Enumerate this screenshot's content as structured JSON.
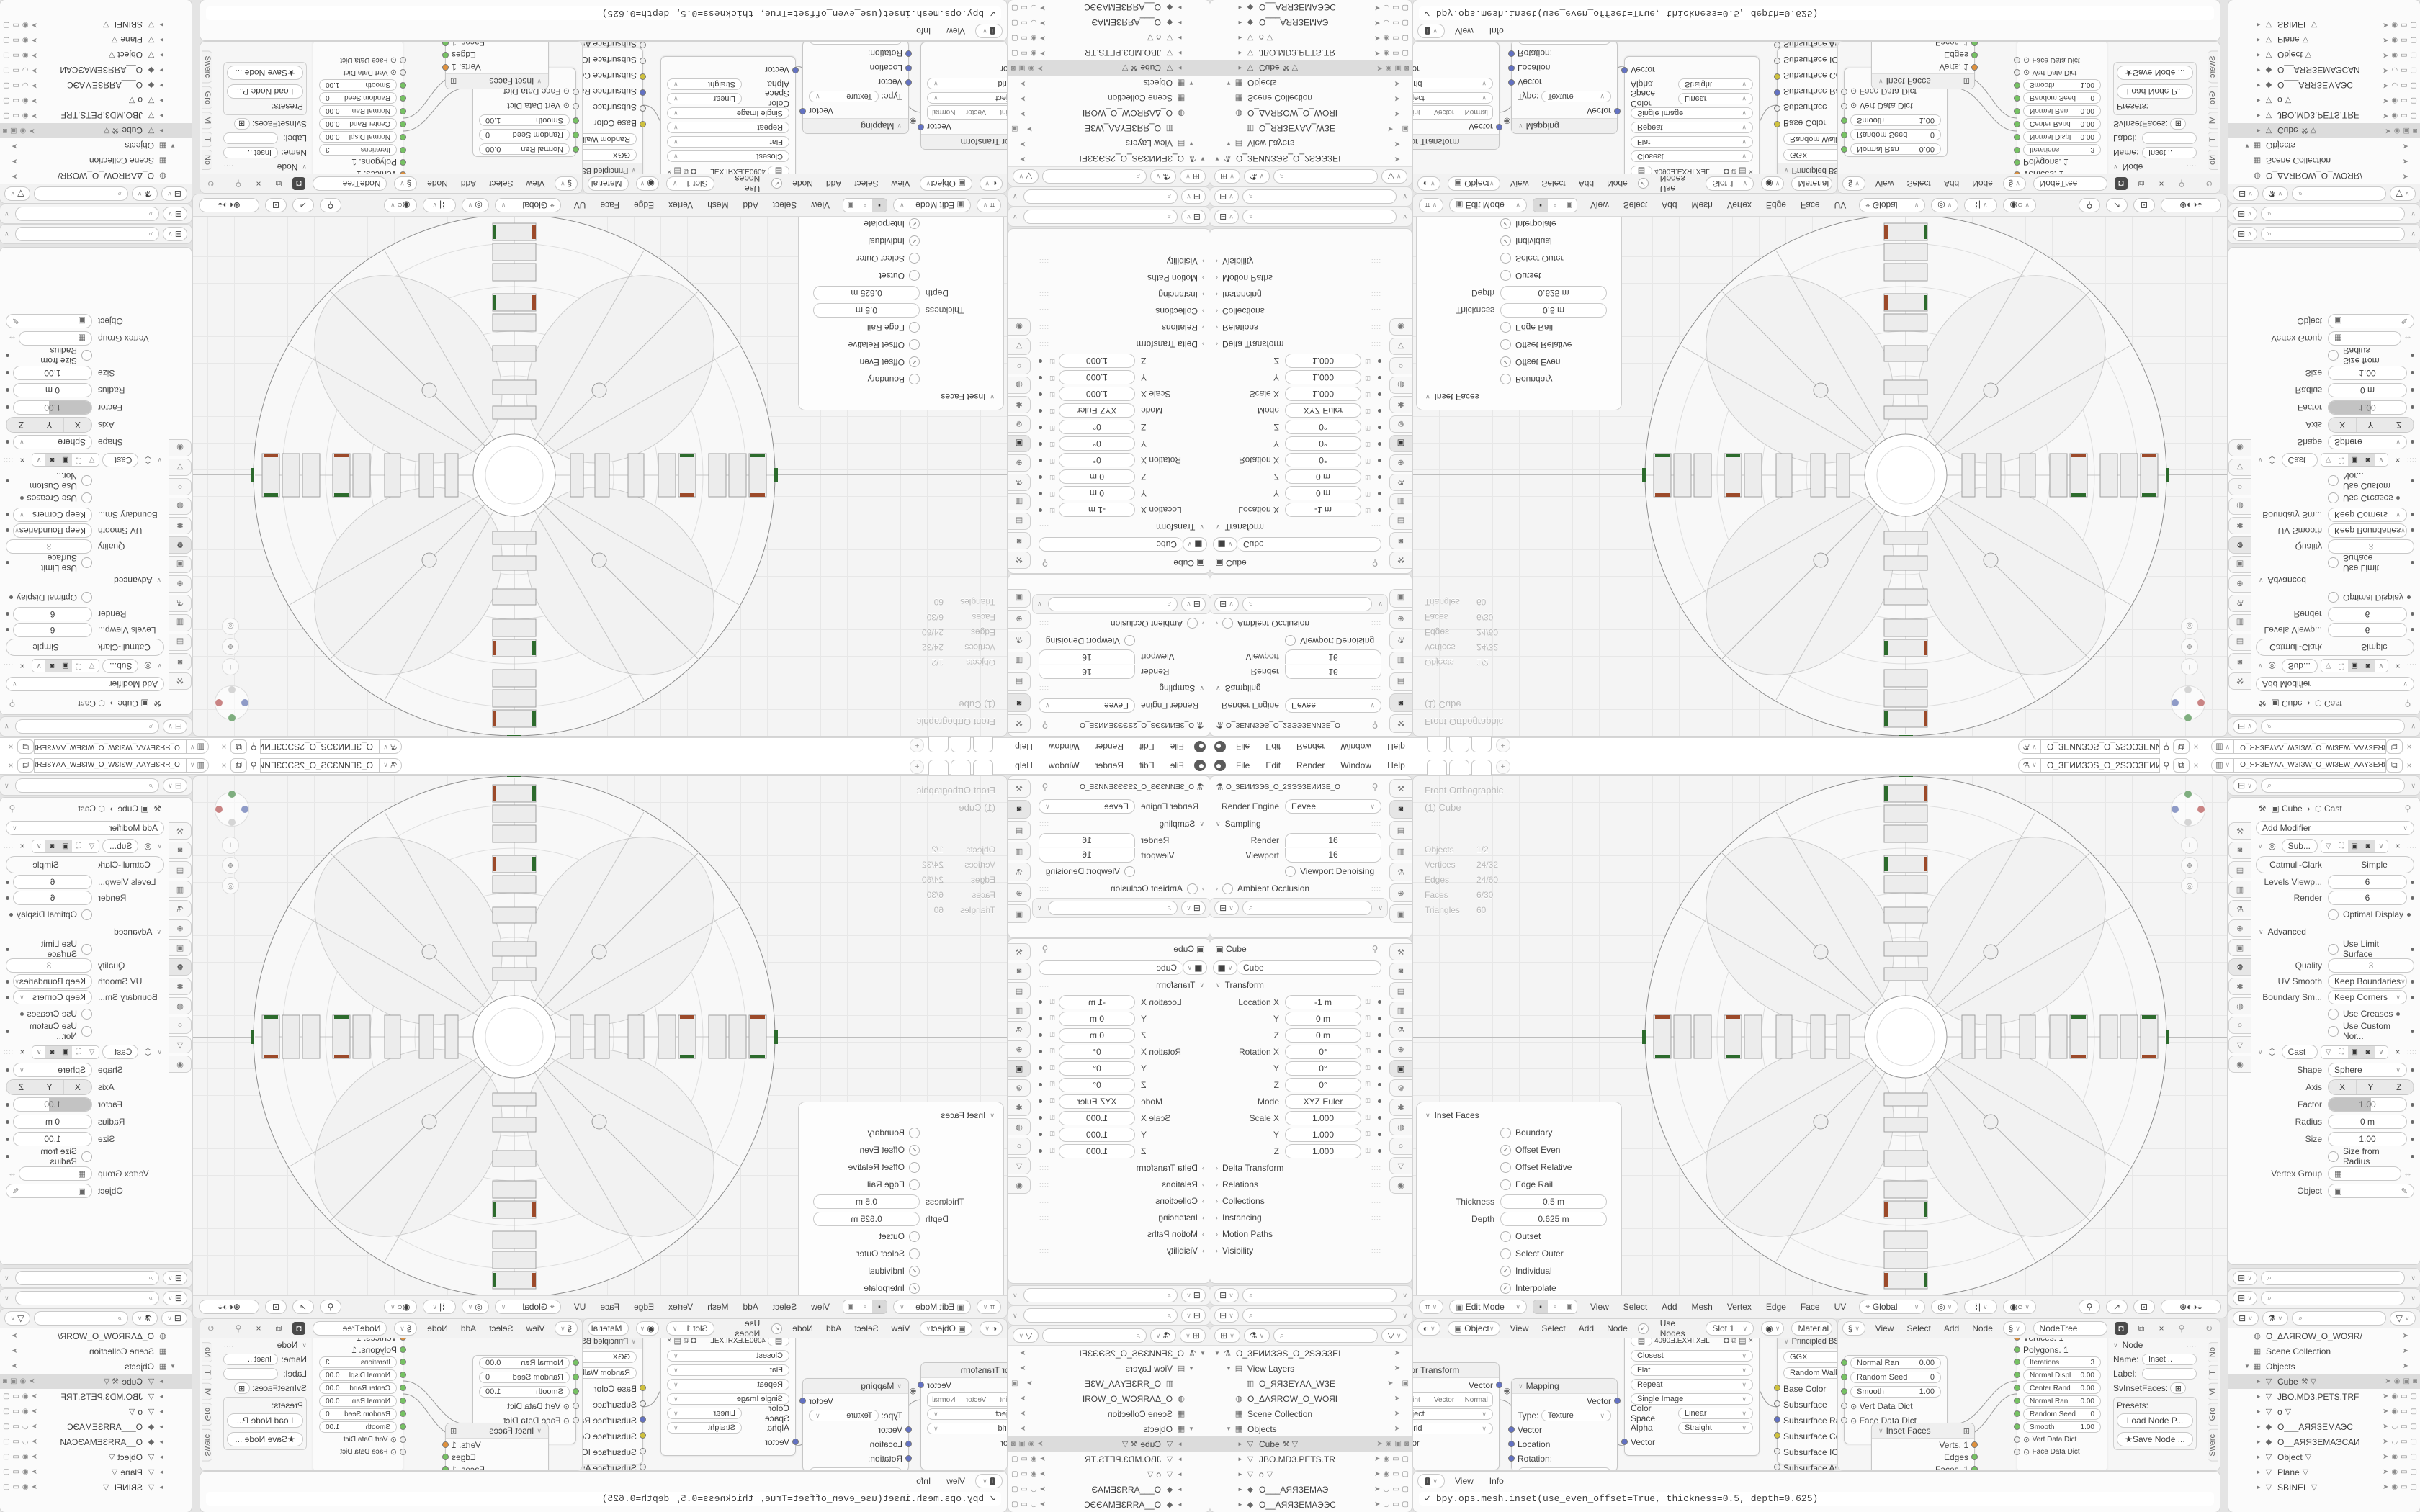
{
  "colors": {
    "accent": "#5680c2",
    "selection": "#dcdcdc",
    "socket_green": "#76c263",
    "socket_orange": "#e0913c",
    "socket_blue": "#6271c3",
    "socket_yellow": "#cfc13e",
    "arm_green": "#2d6b2d",
    "arm_red": "#9c4a2a"
  },
  "topbar": {
    "menus": [
      "File",
      "Edit",
      "Render",
      "Window",
      "Help"
    ],
    "workspace_tabs": [
      {
        "on": ""
      },
      {
        "on": ""
      },
      {
        "on": "1"
      }
    ],
    "new_tab": "+",
    "scene": "O_ЗЕИИЗЭЅ_О_2ЅЭЭЗЕИИ...",
    "view_layer": "O_ЯЯЗЕYАΛ_WЗІЗW_О_WІЗЕW_ΛАYЗЕЯЯ_О"
  },
  "props_render": {
    "title": "O_ЗЕИИЗЭЅ_О_2ЅЭЭЗЕИИЗЕ_О",
    "engine_label": "Render Engine",
    "engine": "Eevee",
    "sampling": "Sampling",
    "render_label": "Render",
    "render": "16",
    "viewport_label": "Viewport",
    "viewport": "16",
    "denoising": "Viewport Denoising",
    "ao": "Ambient Occlusion"
  },
  "props_object": {
    "title": "Cube",
    "id": "Cube",
    "transform": "Transform",
    "fields": [
      {
        "label": "Location X",
        "value": "-1 m"
      },
      {
        "label": "Y",
        "value": "0 m"
      },
      {
        "label": "Z",
        "value": "0 m"
      },
      {
        "label": "Rotation X",
        "value": "0°"
      },
      {
        "label": "Y",
        "value": "0°"
      },
      {
        "label": "Z",
        "value": "0°"
      },
      {
        "label": "Mode",
        "value": "XYZ Euler"
      },
      {
        "label": "Scale X",
        "value": "1.000"
      },
      {
        "label": "Y",
        "value": "1.000"
      },
      {
        "label": "Z",
        "value": "1.000"
      }
    ],
    "sections": [
      "Delta Transform",
      "Relations",
      "Collections",
      "Instancing",
      "Motion Paths",
      "Visibility"
    ]
  },
  "tabs_a": [
    {
      "g": "⚒",
      "name": "tool",
      "on": ""
    },
    {
      "g": "◙",
      "name": "render",
      "on": "1"
    },
    {
      "g": "▤",
      "name": "output",
      "on": ""
    },
    {
      "g": "▥",
      "name": "view-layer",
      "on": ""
    },
    {
      "g": "⚗",
      "name": "scene",
      "on": ""
    },
    {
      "g": "⊕",
      "name": "world",
      "on": ""
    },
    {
      "g": "▣",
      "name": "object",
      "on": ""
    }
  ],
  "tabs_b": [
    {
      "g": "⚒",
      "name": "tool",
      "on": ""
    },
    {
      "g": "◙",
      "name": "render",
      "on": ""
    },
    {
      "g": "▤",
      "name": "output",
      "on": ""
    },
    {
      "g": "▥",
      "name": "view-layer",
      "on": ""
    },
    {
      "g": "⚗",
      "name": "scene",
      "on": ""
    },
    {
      "g": "⊕",
      "name": "world",
      "on": ""
    },
    {
      "g": "▣",
      "name": "object",
      "on": "1"
    },
    {
      "g": "⚙",
      "name": "modifiers",
      "on": ""
    },
    {
      "g": "✱",
      "name": "particles",
      "on": ""
    },
    {
      "g": "◍",
      "name": "physics",
      "on": ""
    },
    {
      "g": "○",
      "name": "constraints",
      "on": ""
    },
    {
      "g": "▽",
      "name": "object-data",
      "on": ""
    },
    {
      "g": "◉",
      "name": "material",
      "on": ""
    }
  ],
  "tabs_r": [
    {
      "g": "⚒",
      "name": "tool",
      "on": ""
    },
    {
      "g": "◙",
      "name": "render",
      "on": ""
    },
    {
      "g": "▤",
      "name": "output",
      "on": ""
    },
    {
      "g": "▥",
      "name": "view-layer",
      "on": ""
    },
    {
      "g": "⚗",
      "name": "scene",
      "on": ""
    },
    {
      "g": "⊕",
      "name": "world",
      "on": ""
    },
    {
      "g": "▣",
      "name": "object",
      "on": ""
    },
    {
      "g": "⚙",
      "name": "modifiers",
      "on": "1"
    },
    {
      "g": "✱",
      "name": "particles",
      "on": ""
    },
    {
      "g": "◍",
      "name": "physics",
      "on": ""
    },
    {
      "g": "○",
      "name": "constraints",
      "on": ""
    },
    {
      "g": "▽",
      "name": "object-data",
      "on": ""
    },
    {
      "g": "◉",
      "name": "material",
      "on": ""
    }
  ],
  "outliner_left": {
    "rows": [
      {
        "icon": "⚗",
        "name": "scene",
        "arrow": "▼",
        "label": "O_ЗЕИИЗЭЅ_О_2ЅЭЭЗЕІ",
        "d": 0,
        "dim": "",
        "sel": "",
        "eye": "",
        "mon": "",
        "cam": ""
      },
      {
        "icon": "▤",
        "name": "view-layers",
        "arrow": "▼",
        "label": "View Layers",
        "d": 1,
        "dim": "",
        "sel": "",
        "eye": "",
        "mon": "",
        "cam": ""
      },
      {
        "icon": "▥",
        "name": "view-layer",
        "arrow": "",
        "label": "O_ЯЯЗЕYАΛ_WЗЕ",
        "d": 2,
        "dim": "",
        "sel": "",
        "eye": "",
        "mon": "",
        "cam": "▣"
      },
      {
        "icon": "◍",
        "name": "world",
        "arrow": "",
        "label": "O_ΔΛЯROW_O_WОЯІ",
        "d": 1,
        "dim": "",
        "sel": "",
        "eye": "",
        "mon": "",
        "cam": ""
      },
      {
        "icon": "▦",
        "name": "collection",
        "arrow": "",
        "label": "Scene Collection",
        "d": 1,
        "dim": "",
        "sel": "",
        "eye": "",
        "mon": "",
        "cam": ""
      },
      {
        "icon": "▦",
        "name": "collection",
        "arrow": "▼",
        "label": "Objects",
        "d": 1,
        "dim": "",
        "sel": "",
        "eye": "",
        "mon": "",
        "cam": ""
      },
      {
        "icon": "▽",
        "name": "mesh-object",
        "arrow": "►",
        "label": "Cube",
        "d": 2,
        "dim": "",
        "sel": "1",
        "extra": "⚒ ▽",
        "eye": "◉",
        "mon": "▣",
        "cam": "◙"
      },
      {
        "icon": "▽",
        "name": "mesh-object",
        "arrow": "►",
        "label": "JBO.MD3.PETS.TR",
        "d": 2,
        "dim": "1",
        "sel": "",
        "eye": "◉",
        "mon": "▭",
        "cam": "▢"
      },
      {
        "icon": "▽",
        "name": "mesh-object",
        "arrow": "►",
        "label": "o",
        "d": 2,
        "dim": "1",
        "sel": "",
        "extra": "▽",
        "eye": "◉",
        "mon": "▭",
        "cam": "▢"
      },
      {
        "icon": "◆",
        "name": "camera-object",
        "arrow": "►",
        "label": "O___АЯЯЗЕМАЭ",
        "d": 2,
        "dim": "1",
        "sel": "",
        "eye": "◡",
        "mon": "▭",
        "cam": "▢"
      },
      {
        "icon": "◆",
        "name": "camera-object",
        "arrow": "►",
        "label": "O__АЯЯЗЕМАЭЭС",
        "d": 2,
        "dim": "1",
        "sel": "",
        "eye": "◡",
        "mon": "▭",
        "cam": "▢"
      }
    ]
  },
  "outliner_right": {
    "rows": [
      {
        "icon": "◍",
        "name": "world",
        "arrow": "",
        "label": "O_ΔΛЯROW_O_WОЯR/",
        "d": 1,
        "dim": "",
        "sel": "",
        "eye": "",
        "mon": "",
        "cam": ""
      },
      {
        "icon": "▦",
        "name": "collection",
        "arrow": "",
        "label": "Scene Collection",
        "d": 1,
        "dim": "",
        "sel": "",
        "eye": "",
        "mon": "",
        "cam": ""
      },
      {
        "icon": "▦",
        "name": "collection",
        "arrow": "▼",
        "label": "Objects",
        "d": 1,
        "dim": "",
        "sel": "",
        "eye": "",
        "mon": "",
        "cam": ""
      },
      {
        "icon": "▽",
        "name": "mesh-object",
        "arrow": "►",
        "label": "Cube",
        "d": 2,
        "dim": "",
        "sel": "1",
        "extra": "⚒ ▽",
        "eye": "◉",
        "mon": "▣",
        "cam": "◙"
      },
      {
        "icon": "▽",
        "name": "mesh-object",
        "arrow": "►",
        "label": "JBO.MD3.PETS.TRF",
        "d": 2,
        "dim": "1",
        "sel": "",
        "eye": "◉",
        "mon": "▭",
        "cam": "▢"
      },
      {
        "icon": "▽",
        "name": "mesh-object",
        "arrow": "►",
        "label": "o",
        "d": 2,
        "dim": "1",
        "sel": "",
        "extra": "▽",
        "eye": "◉",
        "mon": "▭",
        "cam": "▢"
      },
      {
        "icon": "◆",
        "name": "camera-object",
        "arrow": "►",
        "label": "O___АЯЯЗЕМАЭС",
        "d": 2,
        "dim": "1",
        "sel": "",
        "eye": "◡",
        "mon": "▭",
        "cam": "▢"
      },
      {
        "icon": "◆",
        "name": "camera-object",
        "arrow": "►",
        "label": "O__АЯЯЗЕМАЭСАИ",
        "d": 2,
        "dim": "1",
        "sel": "",
        "eye": "◡",
        "mon": "▭",
        "cam": "▢"
      },
      {
        "icon": "▽",
        "name": "mesh-object",
        "arrow": "►",
        "label": "Object",
        "d": 2,
        "dim": "1",
        "sel": "",
        "extra": "▽",
        "eye": "◉",
        "mon": "▭",
        "cam": "▢"
      },
      {
        "icon": "▽",
        "name": "mesh-object",
        "arrow": "►",
        "label": "Plane",
        "d": 2,
        "dim": "1",
        "sel": "",
        "extra": "▽",
        "eye": "◉",
        "mon": "▭",
        "cam": "▢"
      },
      {
        "icon": "▽",
        "name": "mesh-object",
        "arrow": "►",
        "label": "SBINEL",
        "d": 2,
        "dim": "1",
        "sel": "",
        "extra": "▽",
        "eye": "◉",
        "mon": "▭",
        "cam": "▢"
      }
    ]
  },
  "viewport": {
    "view_label": "Front Orthographic",
    "active_object": "(1) Cube",
    "stats": [
      {
        "k": "Objects",
        "v": "1/2"
      },
      {
        "k": "Vertices",
        "v": "24/32"
      },
      {
        "k": "Edges",
        "v": "24/60"
      },
      {
        "k": "Faces",
        "v": "6/30"
      },
      {
        "k": "Triangles",
        "v": "60"
      }
    ],
    "header": {
      "mode": "Edit Mode",
      "menus": [
        "View",
        "Select",
        "Add",
        "Mesh",
        "Vertex",
        "Edge",
        "Face",
        "UV"
      ],
      "orientation": "Global"
    }
  },
  "inset_panel": {
    "title": "Inset Faces",
    "options": [
      {
        "label": "Boundary",
        "mark": ""
      },
      {
        "label": "Offset Even",
        "mark": "✓"
      },
      {
        "label": "Offset Relative",
        "mark": ""
      },
      {
        "label": "Edge Rail",
        "mark": ""
      }
    ],
    "thickness_label": "Thickness",
    "thickness": "0.5 m",
    "depth_label": "Depth",
    "depth": "0.625 m",
    "options2": [
      {
        "label": "Outset",
        "mark": ""
      },
      {
        "label": "Select Outer",
        "mark": ""
      },
      {
        "label": "Individual",
        "mark": "✓"
      },
      {
        "label": "Interpolate",
        "mark": "✓"
      }
    ]
  },
  "shader": {
    "header": {
      "object": "Object",
      "menus": [
        "View",
        "Select",
        "Add",
        "Node"
      ],
      "use_nodes": "Use Nodes",
      "slot": "Slot 1",
      "material": "Material"
    },
    "breadcrumb": [
      "Cube",
      "Cube",
      "Material"
    ],
    "vector_transform": {
      "title": "Vector Transform",
      "output": "Vector",
      "segments": [
        "Point",
        "Vector",
        "Normal"
      ],
      "fields": [
        "Object",
        "World"
      ],
      "input": "Vector"
    },
    "mapping": {
      "title": "Mapping",
      "output": "Vector",
      "type_label": "Type:",
      "type": "Texture",
      "inputs": [
        "Vector",
        "Location",
        "Rotation:"
      ],
      "partial": "X          0°"
    },
    "image_texture": {
      "name": "4090Ǝ.EXЯI.XƎL",
      "rows": [
        "Closest",
        "Flat",
        "Repeat",
        "Single Image"
      ],
      "colorspace_label": "Color Space",
      "colorspace": "Linear",
      "alpha_label": "Alpha",
      "alpha": "Straight",
      "input": "Vector"
    },
    "principled": {
      "title": "Principled BSDF",
      "rows": [
        "GGX",
        "Random Walk"
      ],
      "sockets": [
        {
          "label": "Base Color",
          "sock": "y",
          "kind": "plain"
        },
        {
          "label": "Subsurface",
          "sock": "w",
          "kind": "pill"
        },
        {
          "label": "Subsurface Radi",
          "sock": "b",
          "kind": "pill"
        },
        {
          "label": "Subsurface Color",
          "sock": "y",
          "kind": "plain"
        },
        {
          "label": "Subsurface IOR",
          "sock": "w",
          "kind": "slider"
        },
        {
          "label": "Subsurface Ani",
          "sock": "w",
          "kind": "pill"
        }
      ]
    }
  },
  "node_editor": {
    "header": {
      "menus": [
        "View",
        "Select",
        "Add",
        "Node"
      ],
      "tree": "NodeTree"
    },
    "node_a": {
      "pills": [
        {
          "label": "Normal Ran",
          "value": "0.00"
        },
        {
          "label": "Random Seed",
          "value": "0"
        },
        {
          "label": "Smooth",
          "value": "1.00"
        }
      ],
      "dicts": [
        "Vert Data Dict",
        "Face Data Dict"
      ]
    },
    "inset_node": {
      "title": "Inset Faces",
      "outputs": [
        {
          "label": "Verts. 1",
          "sock": "o"
        },
        {
          "label": "Edges",
          "sock": "g"
        },
        {
          "label": "Faces. 1",
          "sock": "g"
        },
        {
          "label": "Face data",
          "sock": "g"
        }
      ]
    },
    "node_b": {
      "plain": [
        {
          "label": "Vertices. 1",
          "sock": "o"
        },
        {
          "label": "Polygons. 1",
          "sock": "g"
        }
      ],
      "pills": [
        {
          "label": "Iterations",
          "value": "3",
          "sock": "g"
        },
        {
          "label": "Normal Displ",
          "value": "0.00",
          "sock": "g"
        },
        {
          "label": "Center Rand",
          "value": "0.00",
          "sock": "g"
        },
        {
          "label": "Normal Ran",
          "value": "0.00",
          "sock": "g"
        },
        {
          "label": "Random Seed",
          "value": "0",
          "sock": "g"
        },
        {
          "label": "Smooth",
          "value": "1.00",
          "sock": "g"
        }
      ],
      "dicts": [
        "Vert Data Dict",
        "Face Data Dict"
      ]
    },
    "npanel": {
      "title": "Node",
      "name_label": "Name:",
      "name": "Inset ..",
      "label_label": "Label:",
      "sv_label": "SvInsetFaces:",
      "presets": "Presets:",
      "load": "Load Node P...",
      "save": "Save Node ..."
    },
    "side_tabs": [
      "No",
      "T",
      "Vi",
      "Gro",
      "Swerc"
    ]
  },
  "info": {
    "menus": [
      "View",
      "Info"
    ],
    "check": "✓",
    "line": "bpy.ops.mesh.inset(use_even_offset=True, thickness=0.5, depth=0.625)"
  },
  "modifier_panel": {
    "breadcrumb_object": "Cube",
    "breadcrumb_mod": "Cast",
    "add": "Add Modifier",
    "subsurf": {
      "name": "Sub...",
      "type_tabs": [
        {
          "label": "Catmull-Clark",
          "on": "1"
        },
        {
          "label": "Simple",
          "on": ""
        }
      ],
      "rows": [
        {
          "label": "Levels Viewp...",
          "value": "6"
        },
        {
          "label": "Render",
          "value": "6"
        }
      ],
      "optimal": "Optimal Display",
      "advanced": "Advanced",
      "use_limit": "Use Limit Surface",
      "quality_label": "Quality",
      "quality": "3",
      "uv_label": "UV Smooth",
      "uv": "Keep Boundaries",
      "boundary_label": "Boundary Sm...",
      "boundary": "Keep Corners",
      "creases": "Use Creases",
      "custom": "Use Custom Nor..."
    },
    "cast": {
      "name": "Cast",
      "shape_label": "Shape",
      "shape": "Sphere",
      "axis_label": "Axis",
      "axis": [
        "X",
        "Y",
        "Z"
      ],
      "factor_label": "Factor",
      "factor": "1.00",
      "radius_label": "Radius",
      "radius": "0 m",
      "size_label": "Size",
      "size": "1.00",
      "size_from": "Size from Radius",
      "vg_label": "Vertex Group",
      "object_label": "Object"
    }
  }
}
